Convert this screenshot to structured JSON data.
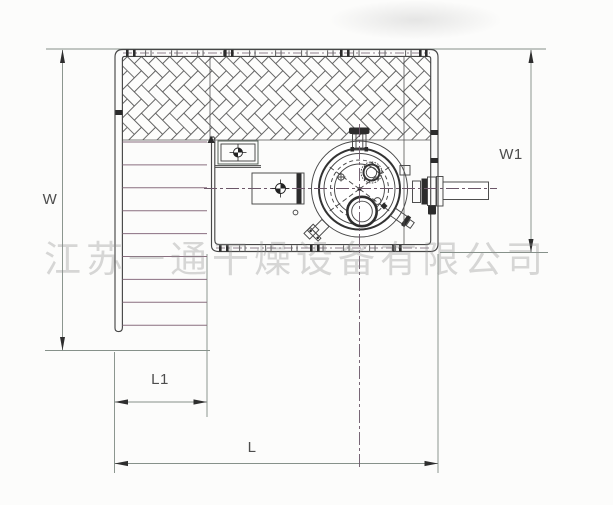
{
  "drawing": {
    "title": "drying-equipment-top-view",
    "dimensions": {
      "left": "W",
      "right": "W1",
      "bottom_inner": "L1",
      "bottom_outer": "L"
    },
    "watermark": {
      "text": "江苏一通干燥设备有限公司"
    },
    "ladder": {
      "rung_count": 9
    },
    "colors": {
      "line": "#474747",
      "hatch": "#5d5d5d",
      "dimension": "#86918a",
      "arrow": "#2e2e2e",
      "rung": "#8a6f80",
      "centerline": "#6b5668",
      "dark_fill": "#2c2c2c",
      "watermark": "#8f8f8f"
    }
  }
}
